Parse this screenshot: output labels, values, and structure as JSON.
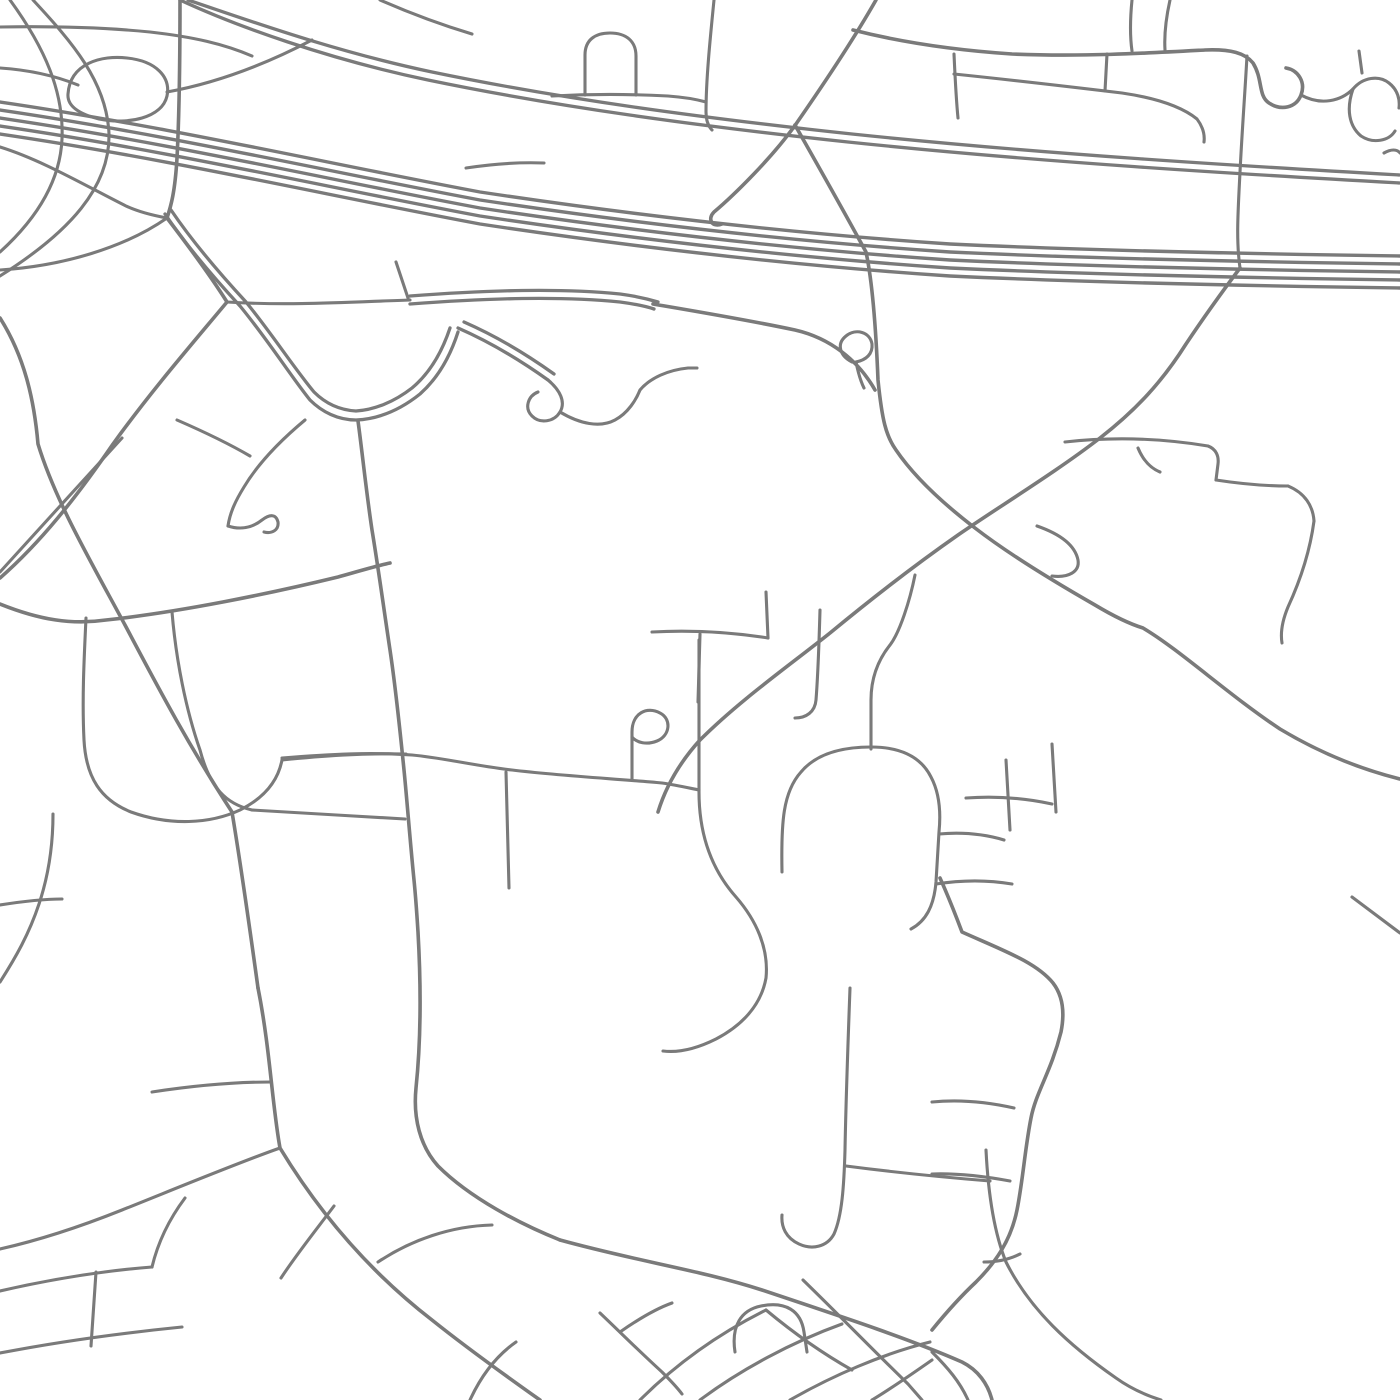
{
  "canvas": {
    "width": 1400,
    "height": 1400,
    "background_color": "#ffffff"
  },
  "map": {
    "style": "minimal-street-map-no-labels",
    "road_color": "#7a7a7a",
    "road_groups": [
      {
        "name": "freeway-carriageways",
        "stroke_width": 3.4,
        "paths": [
          "M 0,102 C 170,127 330,164 480,192 C 640,216 800,234 950,244 C 1100,251 1260,254 1400,256",
          "M 0,110 C 170,135 330,172 480,200 C 640,224 800,242 950,252 C 1100,259 1260,262 1400,264",
          "M 0,118 C 170,143 330,180 480,208 C 640,232 800,250 950,260 C 1100,267 1260,270 1400,272",
          "M 0,126 C 170,151 330,188 480,216 C 640,240 800,258 950,268 C 1100,275 1260,278 1400,280",
          "M 0,134 C 170,159 330,196 480,224 C 640,248 800,266 950,276 C 1100,283 1260,286 1400,288"
        ]
      },
      {
        "name": "divided-highway",
        "stroke_width": 3.3,
        "paths": [
          "M 188,0 C 242,18 332,51 432,72 C 562,99 702,118 852,134 C 1042,154 1242,166 1400,175",
          "M 180,0 C 236,26 328,59 428,80 C 558,107 698,126 848,142 C 1038,162 1238,174 1400,183",
          "M 410,296 C 490,290 560,288 620,294 C 635,296 648,299 658,302",
          "M 410,304 C 490,298 560,296 620,302 C 635,304 645,306 654,309",
          "M 165,214 C 188,248 216,280 240,306 C 268,340 290,375 310,400 C 322,412 338,420 356,420 C 378,419 400,410 420,394 C 438,378 450,357 458,332",
          "M 171,210 C 194,244 222,276 246,302 C 272,334 294,368 314,392 C 324,402 338,410 356,411 C 374,410 394,402 412,388 C 430,373 442,352 450,328",
          "M 458,328 C 490,342 520,360 548,380",
          "M 464,322 C 496,336 526,354 554,374"
        ]
      },
      {
        "name": "major-roads",
        "stroke_width": 3.6,
        "paths": [
          "M 180,0 C 180,60 179,120 177,158 C 175,192 171,206 167,218",
          "M 167,218 C 190,248 210,275 227,302",
          "M 653,304 C 700,312 748,320 795,330 C 830,338 858,360 875,390",
          "M 795,125 C 816,162 841,206 866,252 C 872,280 876,330 878,380 C 882,420 886,436 896,450 C 915,478 945,505 975,528 C 1010,555 1060,585 1095,605 C 1115,617 1130,624 1143,628 C 1180,650 1230,696 1280,729 C 1320,753 1360,769 1400,779",
          "M 1240,268 C 1222,292 1202,320 1186,344 C 1162,382 1136,410 1100,438 C 1056,472 1000,506 958,535 C 915,565 870,600 830,633 C 790,665 740,700 700,740 C 680,762 666,786 658,812",
          "M 358,421 C 362,450 366,490 372,530 C 378,566 384,610 390,650 C 396,690 400,730 404,770 C 407,800 410,840 414,880 C 416,900 417,916 418,932 C 421,985 421,1040 416,1088 C 413,1118 420,1146 438,1166 C 470,1198 520,1224 560,1240",
          "M 560,1240 C 640,1262 700,1270 762,1290 C 852,1320 912,1340 962,1362 C 978,1370 988,1384 992,1400",
          "M 0,318 C 24,356 34,398 38,444 C 55,500 90,560 125,625 C 150,672 185,740 232,812 C 242,872 250,930 258,988",
          "M 258,988 C 270,1048 272,1104 280,1148 C 320,1214 370,1272 432,1320 C 467,1348 506,1376 540,1400",
          "M 227,302 C 192,344 152,390 113,444 C 76,498 40,543 0,578",
          "M 940,878 C 949,898 956,916 962,932 C 1002,950 1036,962 1053,983 C 1063,996 1065,1012 1061,1032 C 1051,1072 1036,1092 1031,1118 C 1025,1148 1023,1180 1017,1210 C 1011,1240 996,1262 976,1282 C 960,1297 945,1314 932,1330",
          "M 0,604 C 40,620 72,625 106,620 C 180,612 268,594 338,577 C 356,572 376,566 390,563",
          "M 876,0 C 851,44 821,88 796,124 C 772,158 733,196 714,212 C 707,219 712,228 722,224",
          "M 853,30 C 900,42 952,50 1012,54 C 1082,57 1150,53 1205,50 C 1231,49 1245,53 1253,63 C 1263,79 1258,96 1269,103 C 1281,111 1296,108 1301,95 C 1306,82 1298,70 1286,68"
        ]
      },
      {
        "name": "local-roads",
        "stroke_width": 3.1,
        "paths": [
          "M 68,94 C 70,63 102,55 127,58 C 156,61 171,77 167,96 C 162,118 128,125 99,119 C 79,114 67,106 68,94",
          "M 33,0 C 72,42 107,82 109,134 C 110,187 70,232 0,276",
          "M 10,0 C 45,48 64,92 62,139 C 60,185 32,223 0,252",
          "M 0,27 C 58,26 110,28 150,32 C 194,37 224,44 252,56",
          "M 0,68 C 30,70 56,76 78,85",
          "M 167,92 C 222,82 270,62 312,40",
          "M 167,218 C 124,248 62,266 0,270",
          "M 0,147 C 42,160 86,186 126,206 C 141,213 156,216 167,218",
          "M 380,0 C 412,14 442,25 472,34",
          "M 714,0 C 710,40 706,80 706,112 C 706,120 708,126 712,130",
          "M 552,96 C 590,94 630,94 668,96 C 682,97 695,99 706,102",
          "M 585,95 L 585,55 C 585,40 595,33 610,33 C 626,33 636,41 636,56 L 636,95",
          "M 466,168 C 492,164 518,162 544,163",
          "M 1301,95 C 1321,106 1341,101 1353,89 C 1363,77 1379,75 1389,83 C 1398,90 1400,100 1399,108",
          "M 1353,89 C 1346,109 1349,126 1361,136 C 1373,144 1389,141 1395,131",
          "M 954,54 C 955,76 956,98 958,118",
          "M 954,74 C 1012,80 1072,87 1122,93 C 1156,98 1181,106 1197,119 C 1203,127 1205,134 1204,142",
          "M 1107,54 L 1105,91",
          "M 1132,0 C 1130,20 1130,37 1132,51",
          "M 1170,0 C 1166,18 1164,34 1165,50",
          "M 1359,51 L 1362,73",
          "M 1384,153 C 1391,149 1397,149 1400,153",
          "M 1247,56 C 1245,92 1242,132 1240,172 C 1238,212 1236,240 1240,268",
          "M 227,302 C 290,306 350,302 410,300",
          "M 408,298 L 396,262",
          "M 548,380 C 560,390 566,402 560,412 C 554,422 540,424 532,416 C 524,408 528,396 538,392",
          "M 560,412 C 580,424 600,428 615,420 C 628,413 636,400 640,390 C 650,378 668,370 688,368 L 697,368",
          "M 852,362 C 840,356 836,344 846,336 C 856,328 870,332 872,344 C 873,354 866,360 856,362",
          "M 856,362 C 858,372 860,380 864,388",
          "M 0,572 L 122,438",
          "M 305,420 C 281,440 259,462 244,487 C 236,500 230,512 228,526",
          "M 228,526 C 240,530 252,528 262,520 C 270,514 276,514 278,522 C 279,530 272,534 264,532",
          "M 177,420 C 200,430 226,442 250,456",
          "M 86,618 C 84,660 82,700 84,740 C 86,778 101,800 131,812 C 170,826 210,824 240,810 C 264,798 278,781 282,760",
          "M 172,612 C 176,660 186,710 200,750 C 210,788 226,804 252,810",
          "M 252,810 C 300,813 355,816 405,819",
          "M 282,760 C 322,756 362,753 406,754",
          "M 0,905 C 25,901 45,899 62,899",
          "M 0,982 C 16,957 29,934 39,904 C 49,874 53,844 53,814",
          "M 282,758 C 330,754 372,752 412,755 C 444,758 476,766 512,770 C 562,776 620,779 662,783 C 676,785 689,788 699,790",
          "M 632,780 L 632,732 C 632,713 647,706 660,713 C 672,719 670,736 657,741 C 647,745 637,743 632,737",
          "M 506,772 L 509,888",
          "M 652,632 C 690,630 730,632 768,638",
          "M 768,638 L 766,592",
          "M 700,634 L 698,702",
          "M 820,610 C 819,645 818,675 816,700 C 815,712 806,718 795,718",
          "M 1037,526 C 1060,534 1075,545 1078,560 C 1080,572 1068,578 1052,576",
          "M 1065,442 C 1110,437 1160,438 1208,446 C 1216,449 1219,456 1218,464 L 1216,480",
          "M 1216,480 C 1242,484 1266,486 1288,486",
          "M 1288,486 C 1305,493 1313,506 1314,521",
          "M 1314,521 C 1310,551 1300,581 1288,607 C 1283,619 1280,631 1282,643",
          "M 1138,448 C 1143,460 1150,468 1160,472",
          "M 1352,897 L 1400,933",
          "M 699,640 L 699,792 C 699,836 712,870 736,897 C 756,920 769,948 766,978 C 761,1006 741,1026 716,1039 C 696,1049 679,1053 663,1051",
          "M 782,872 C 781,822 783,792 801,772 C 816,754 841,747 871,747 C 901,747 921,757 931,777 C 939,792 941,812 939,832 L 936,882 C 934,906 926,921 911,929",
          "M 939,834 C 962,832 984,834 1004,840",
          "M 871,749 L 871,700 C 871,678 878,660 890,645 C 900,632 910,600 915,575",
          "M 936,884 C 962,880 988,880 1012,884",
          "M 1006,760 L 1010,830",
          "M 966,798 C 995,796 1025,798 1052,804",
          "M 1052,744 L 1056,812",
          "M 932,1102 C 962,1099 992,1103 1014,1108",
          "M 932,1174 C 960,1173 988,1177 1010,1181",
          "M 984,1262 C 998,1262 1010,1259 1020,1254",
          "M 850,988 C 848,1042 846,1096 845,1150 C 844,1186 842,1216 834,1234 C 827,1247 812,1250 799,1244 C 786,1238 781,1227 782,1215",
          "M 846,1166 C 892,1172 940,1177 990,1181",
          "M 986,1150 C 988,1190 993,1230 1006,1262 C 1030,1310 1070,1346 1116,1378 C 1130,1388 1145,1395 1161,1400",
          "M 280,1148 C 240,1162 182,1186 122,1210 C 82,1226 40,1240 0,1249",
          "M 334,1206 C 316,1230 296,1255 281,1278",
          "M 378,1262 C 411,1240 451,1226 492,1225",
          "M 152,1092 C 198,1085 238,1082 271,1082",
          "M 470,1400 C 481,1376 496,1356 516,1342",
          "M 0,1291 C 52,1279 102,1271 152,1267",
          "M 0,1353 C 62,1341 122,1333 182,1327",
          "M 96,1272 L 91,1346",
          "M 152,1267 C 158,1242 170,1218 185,1198",
          "M 640,1400 C 678,1362 722,1332 766,1310",
          "M 700,1400 C 740,1370 792,1342 842,1324",
          "M 790,1400 C 832,1376 882,1354 930,1342",
          "M 872,1400 C 892,1388 912,1374 932,1360",
          "M 735,1352 C 731,1326 741,1310 761,1306 C 786,1301 801,1311 804,1332 L 807,1352",
          "M 766,1310 C 790,1330 820,1352 852,1370",
          "M 600,1313 C 620,1332 640,1352 662,1372 C 668,1378 676,1386 682,1394",
          "M 803,1280 C 840,1316 875,1352 908,1384 L 922,1400",
          "M 620,1332 C 640,1318 658,1308 672,1303",
          "M 932,1352 C 948,1368 960,1382 968,1400"
        ]
      }
    ]
  }
}
